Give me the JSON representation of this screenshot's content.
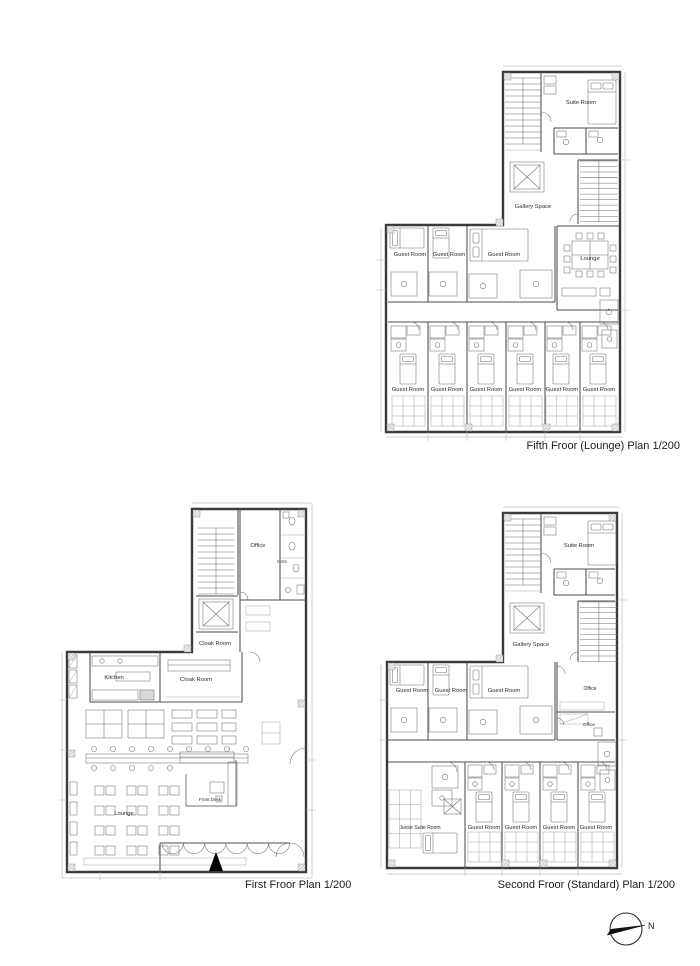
{
  "plans": {
    "fifth": {
      "caption": "Fifth Froor (Lounge) Plan 1/200",
      "labels": {
        "suite_room": "Suite Room",
        "gallery_space": "Gallery Space",
        "lounge": "Lounge"
      },
      "guest_rooms_upper": [
        "Guest Room",
        "Guest Room",
        "Guest Room"
      ],
      "guest_rooms_lower": [
        "Guest Room",
        "Guest Room",
        "Guest Room",
        "Guest Room",
        "Guest Room",
        "Guest Room"
      ]
    },
    "first": {
      "caption": "First Froor Plan 1/200",
      "labels": {
        "office": "Office",
        "cloak_room_upper": "Cloak Room",
        "kitchen": "Kitchen",
        "cloak_room_lower": "Cloak Room",
        "front_desk": "Front Desk",
        "lounge": "Lounge"
      }
    },
    "second": {
      "caption": "Second Froor (Standard) Plan 1/200",
      "labels": {
        "suite_room": "Suite Room",
        "gallery_space": "Gallery Space",
        "office_upper": "Office",
        "office_lower": "Office",
        "junior_suite_room": "Junior Suite Room"
      },
      "guest_rooms_mid": [
        "Guest Room",
        "Guest Room",
        "Guest Room"
      ],
      "guest_rooms_lower": [
        "Guest Room",
        "Guest Room",
        "Guest Room",
        "Guest Room"
      ]
    }
  },
  "compass": {
    "label": "N"
  },
  "line_color": "#3a3a3a",
  "background": "#ffffff"
}
